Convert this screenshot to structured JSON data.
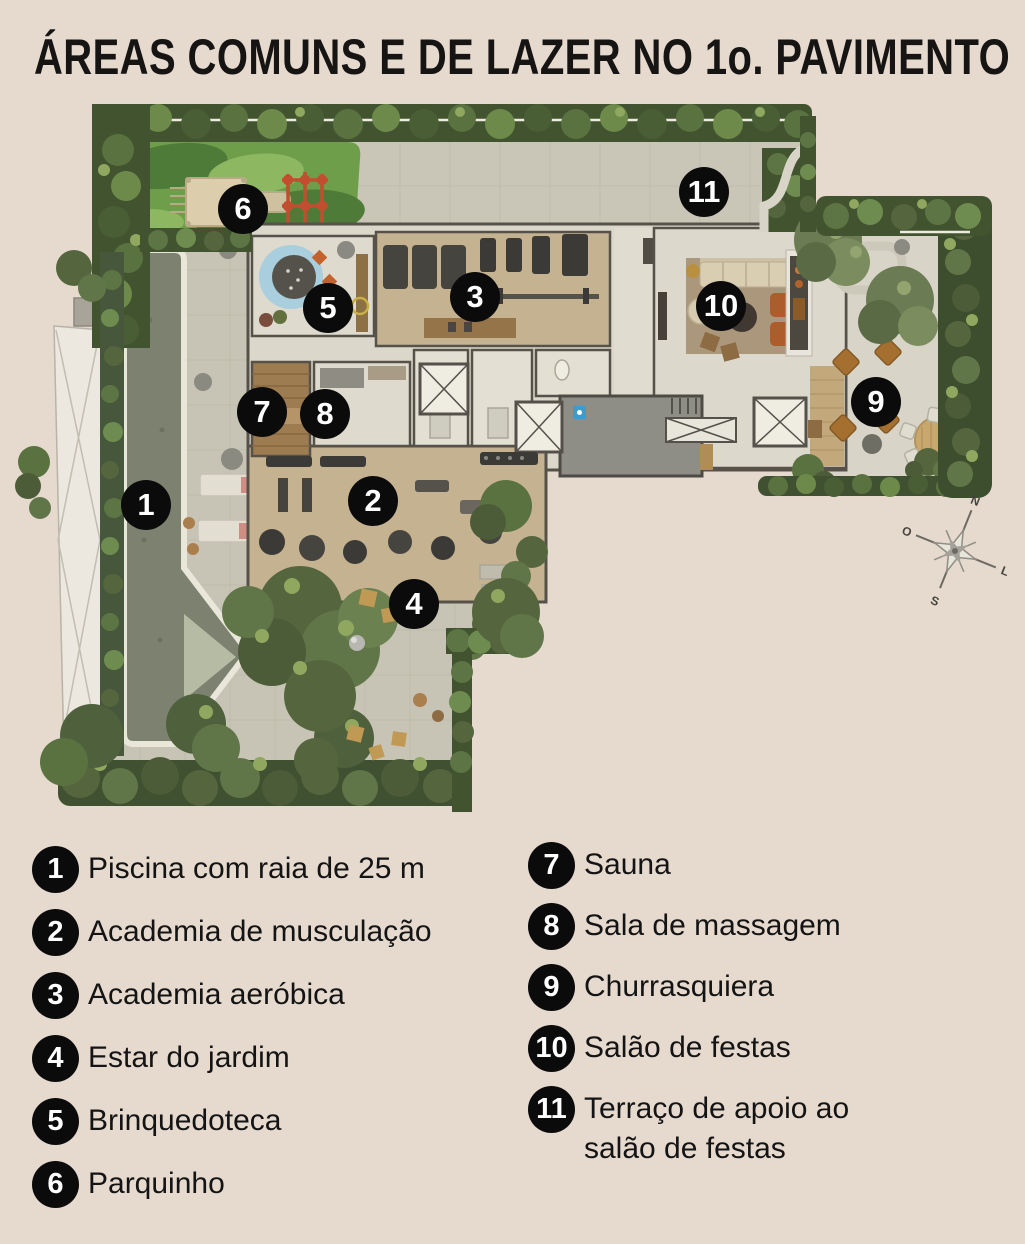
{
  "title": "ÁREAS COMUNS E DE LAZER NO 1o. PAVIMENTO",
  "plan": {
    "markers": [
      {
        "n": "1",
        "x": 146,
        "y": 505
      },
      {
        "n": "2",
        "x": 373,
        "y": 501
      },
      {
        "n": "3",
        "x": 475,
        "y": 297
      },
      {
        "n": "4",
        "x": 414,
        "y": 604
      },
      {
        "n": "5",
        "x": 328,
        "y": 308
      },
      {
        "n": "6",
        "x": 243,
        "y": 209
      },
      {
        "n": "7",
        "x": 262,
        "y": 412
      },
      {
        "n": "8",
        "x": 325,
        "y": 414
      },
      {
        "n": "9",
        "x": 876,
        "y": 402
      },
      {
        "n": "10",
        "x": 721,
        "y": 306
      },
      {
        "n": "11",
        "x": 704,
        "y": 192
      }
    ],
    "compass": {
      "n": "N",
      "s": "S",
      "e": "L",
      "w": "O"
    }
  },
  "legend": {
    "columns": [
      {
        "items": [
          {
            "n": "1",
            "label": "Piscina com raia de 25 m"
          },
          {
            "n": "2",
            "label": "Academia de musculação"
          },
          {
            "n": "3",
            "label": "Academia aeróbica"
          },
          {
            "n": "4",
            "label": "Estar do jardim"
          },
          {
            "n": "5",
            "label": "Brinquedoteca"
          },
          {
            "n": "6",
            "label": "Parquinho"
          }
        ]
      },
      {
        "items": [
          {
            "n": "7",
            "label": "Sauna"
          },
          {
            "n": "8",
            "label": "Sala de massagem"
          },
          {
            "n": "9",
            "label": "Churrasquiera"
          },
          {
            "n": "10",
            "label": "Salão de festas"
          },
          {
            "n": "11",
            "label": "Terraço de apoio ao\nsalão de festas"
          }
        ]
      }
    ]
  },
  "colors": {
    "background": "#e6dacf",
    "marker": "#0b0b0b",
    "marker_text": "#ffffff",
    "hedge_dark": "#42532f",
    "pool_water": "#7c8170",
    "pool_shallow": "#b6bca4",
    "playground_green": "#6f9e4a",
    "paver": "#c8c4b5",
    "room_floor": "#dbd7ca",
    "room_tan": "#c4b291",
    "wall": "#56524a"
  }
}
